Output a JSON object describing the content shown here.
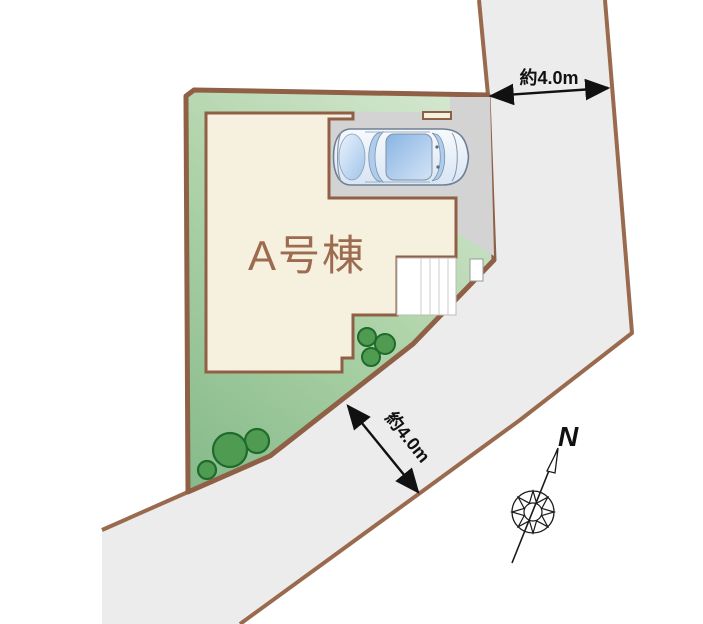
{
  "plan": {
    "building_label": "A号棟",
    "top_road_width_label": "約4.0m",
    "side_road_width_label": "約4.0m",
    "north_label": "N"
  },
  "colors": {
    "boundary_brown": "#8F6045",
    "road_edge_brown": "#9A6A4E",
    "road_fill": "#ECECEC",
    "lot_green_dark": "#83B889",
    "lot_green_light": "#D6E8D2",
    "parking_gray": "#D3D3D3",
    "building_fill": "#F6F0DF",
    "building_label_brown": "#9C6B50",
    "steps_white": "#FFFFFF",
    "tree_green": "#4F9B51",
    "tree_outline_green": "#1F6B2B",
    "car_blue": "#A9C9EC",
    "dimension_black": "#111111"
  }
}
